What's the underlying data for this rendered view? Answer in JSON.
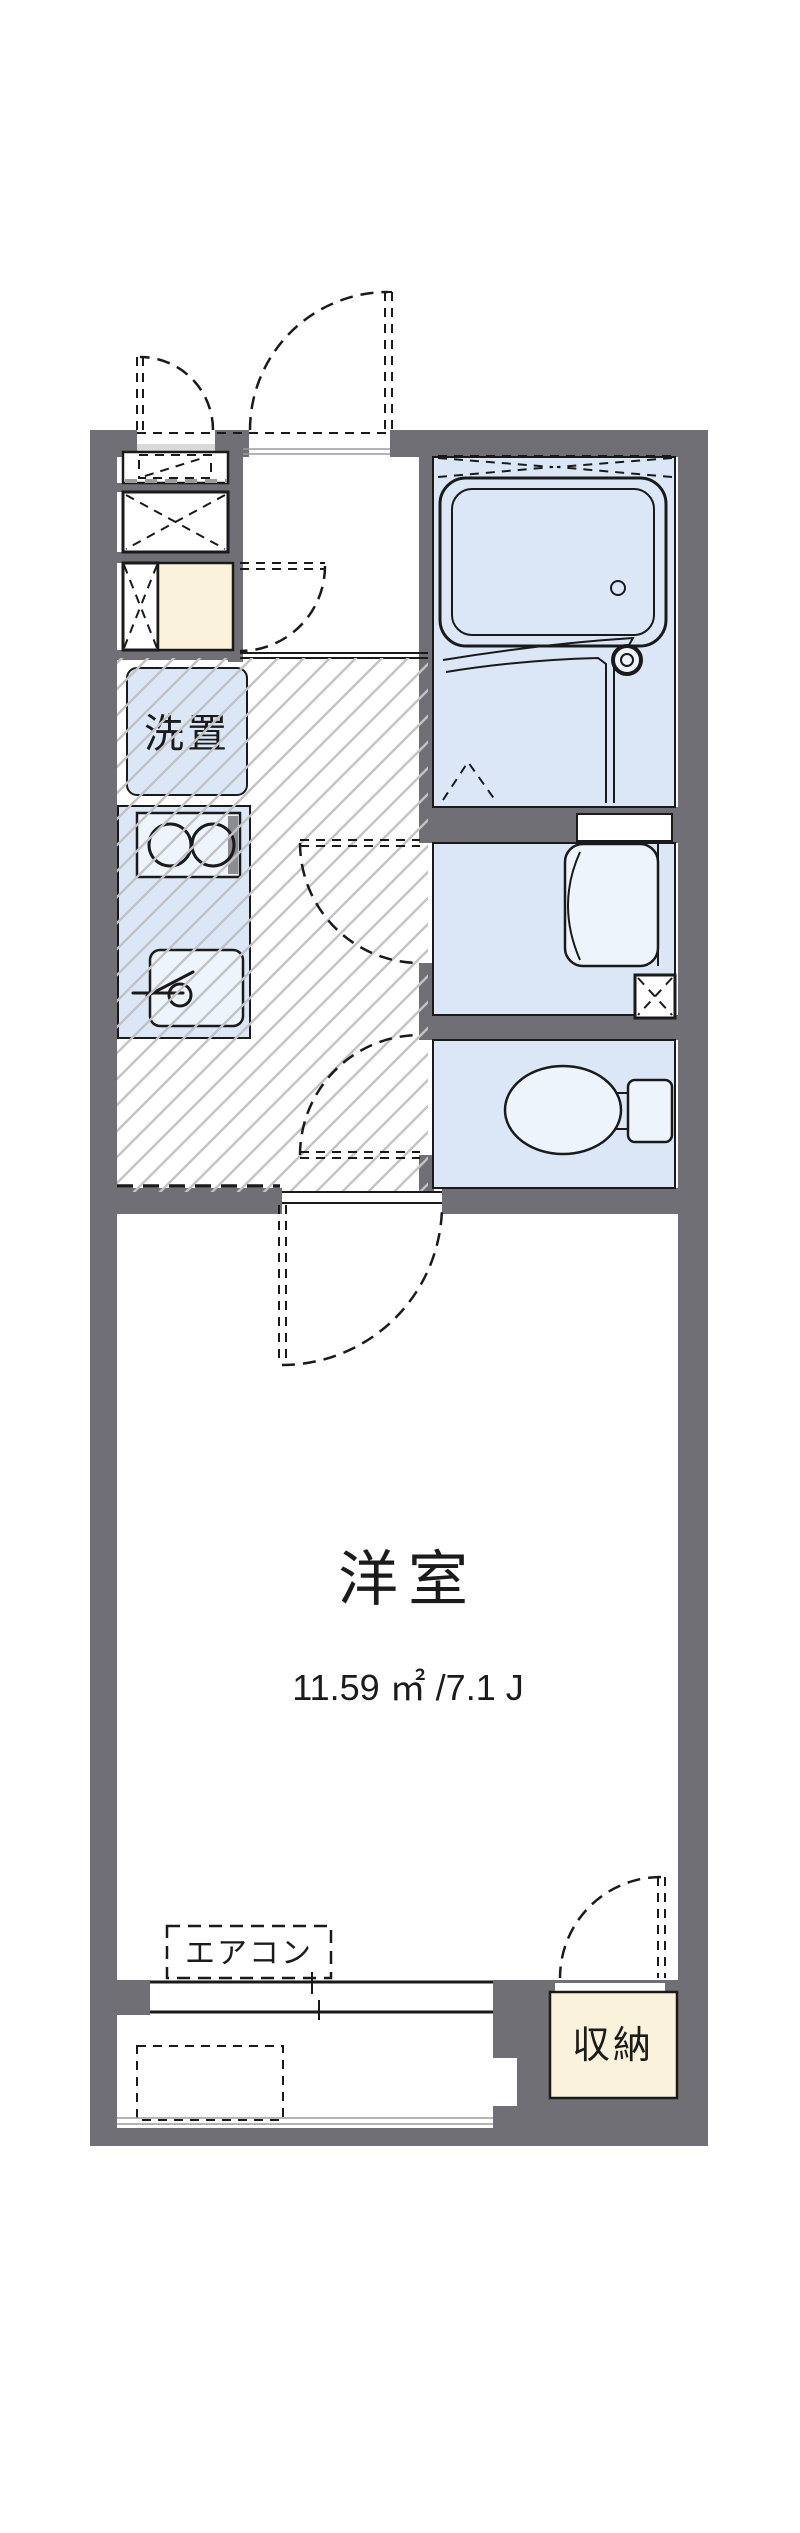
{
  "plan": {
    "rooms": {
      "main_room": {
        "label": "洋室",
        "area_label": "11.59 ㎡ /7.1 J"
      },
      "kitchen": {
        "washer_label": "洗置"
      },
      "storage": {
        "label": "収納"
      },
      "aircon": {
        "label": "エアコン"
      }
    },
    "fixtures": [
      "entrance-door-swing",
      "porch-storage-door-swing",
      "shoe-cabinet",
      "refrigerator-space",
      "washing-machine-space",
      "gas-stove",
      "kitchen-sink",
      "bathtub",
      "bath-faucet",
      "washbasin",
      "pipe-space",
      "toilet",
      "hall-door-swing",
      "washroom-door-swing",
      "toilet-door-swing",
      "main-room-door-swing",
      "closet-door-swing",
      "sliding-window",
      "balcony",
      "air-conditioner-position"
    ],
    "colors": {
      "wall": "#6f6f75",
      "room_fill": "#dbe7f7",
      "fixture_fill": "#eef4fc",
      "storage_fill": "#fbf2dc",
      "hatch": "#c3c3c6",
      "line": "#1a1a1a",
      "threshold": "#d9d9dc",
      "stove_shade": "#8b8b92",
      "soft_line": "#9a9aa0"
    }
  }
}
